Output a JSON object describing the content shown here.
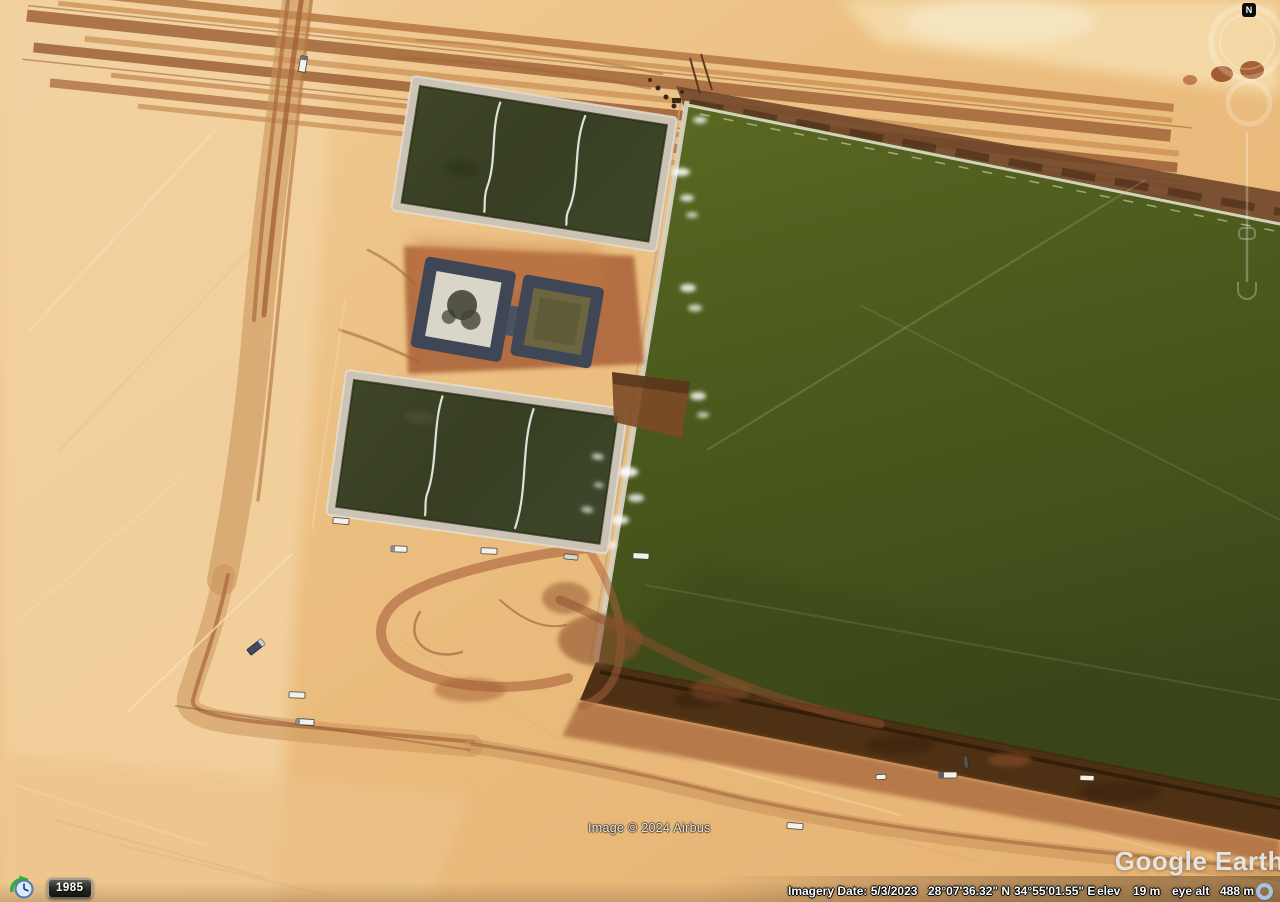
{
  "app": {
    "name": "Google Earth"
  },
  "map": {
    "copyright": "Image © 2024 Airbus",
    "watermark": "Google Earth",
    "scene": "desert water-treatment evaporation ponds, aerial view"
  },
  "navigation": {
    "compass_label": "N",
    "icons": [
      "compass-n-icon",
      "look-joystick-ring",
      "move-joystick-ring",
      "zoom-slider"
    ]
  },
  "time_control": {
    "year": "1985",
    "icon": "historical-imagery-clock-icon"
  },
  "status_bar": {
    "imagery_date": "Imagery Date: 5/3/2023",
    "latitude": "28°07'36.32\" N",
    "longitude": "34°55'01.55\" E",
    "elev_label": "elev",
    "elevation": "19 m",
    "eye_alt_label": "eye alt",
    "eye_altitude": "488 m",
    "streaming_icon": "blue-ring-icon"
  },
  "colors": {
    "desert_sand": "#eec488",
    "desert_light": "#f3d3a2",
    "pond_green": "#4c5a1e",
    "small_pond_dark": "#3c4326",
    "shoreline_dark": "#46290f",
    "road_brown": "#a5663c",
    "basin_liner": "#3f4656",
    "status_text": "#ffffff"
  }
}
